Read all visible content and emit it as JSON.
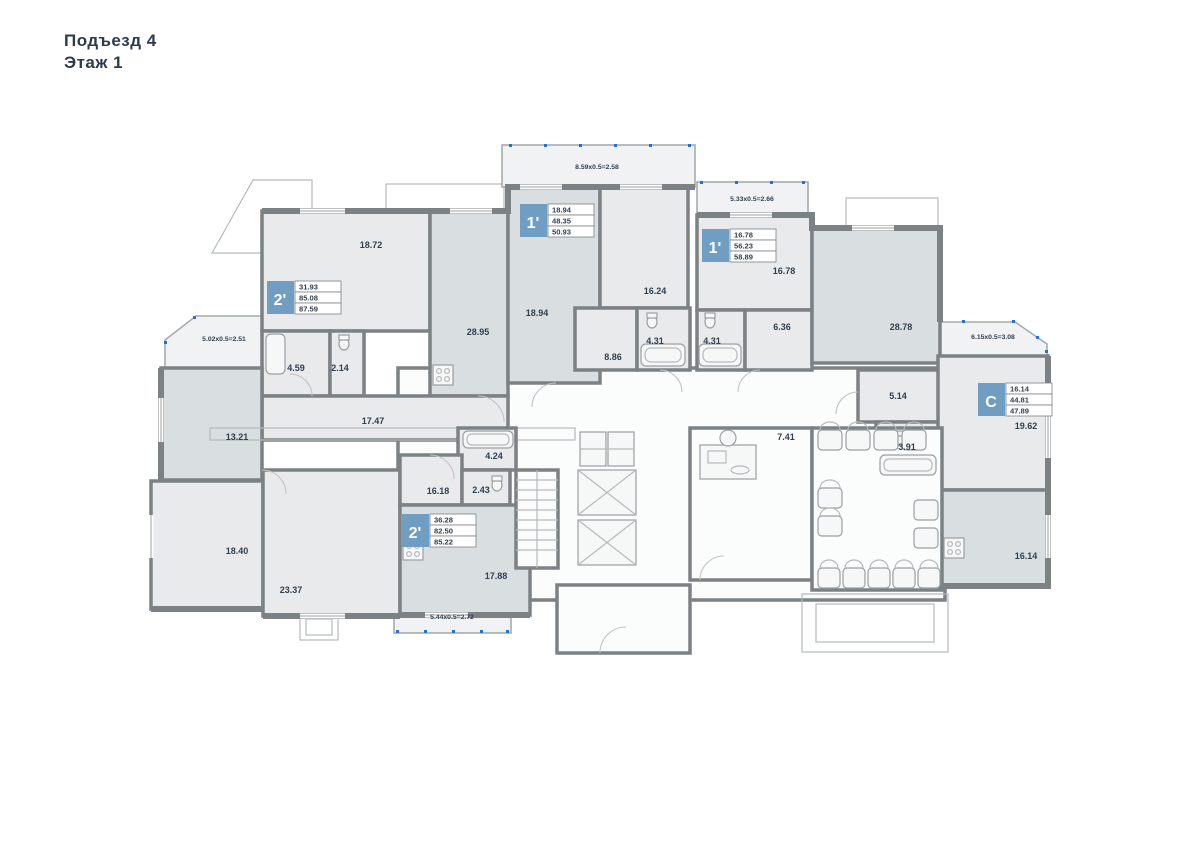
{
  "page": {
    "title_line1": "Подъезд  4",
    "title_line2": "Этаж 1"
  },
  "apartments": [
    {
      "type": "2'",
      "rows": [
        "31.93",
        "85.08",
        "87.59"
      ]
    },
    {
      "type": "1'",
      "rows": [
        "18.94",
        "48.35",
        "50.93"
      ]
    },
    {
      "type": "1'",
      "rows": [
        "16.78",
        "56.23",
        "58.89"
      ]
    },
    {
      "type": "2'",
      "rows": [
        "36.28",
        "82.50",
        "85.22"
      ]
    },
    {
      "type": "С",
      "rows": [
        "16.14",
        "44.81",
        "47.89"
      ]
    }
  ],
  "rooms": [
    {
      "area": "18.72"
    },
    {
      "area": "28.95"
    },
    {
      "area": "18.94"
    },
    {
      "area": "16.24"
    },
    {
      "area": "16.78"
    },
    {
      "area": "28.78"
    },
    {
      "area": "4.59"
    },
    {
      "area": "2.14"
    },
    {
      "area": "8.86"
    },
    {
      "area": "4.31"
    },
    {
      "area": "4.31"
    },
    {
      "area": "6.36"
    },
    {
      "area": "17.47"
    },
    {
      "area": "13.21"
    },
    {
      "area": "5.14"
    },
    {
      "area": "3.91"
    },
    {
      "area": "19.62"
    },
    {
      "area": "7.41"
    },
    {
      "area": "4.24"
    },
    {
      "area": "16.18"
    },
    {
      "area": "2.43"
    },
    {
      "area": "18.40"
    },
    {
      "area": "23.37"
    },
    {
      "area": "17.88"
    },
    {
      "area": "16.14"
    }
  ],
  "balconies": [
    {
      "dim": "8.59x0.5=2.58"
    },
    {
      "dim": "5.33x0.5=2.66"
    },
    {
      "dim": "5.02x0.5=2.51"
    },
    {
      "dim": "6.15x0.5=3.08"
    },
    {
      "dim": "5.44x0.5=2.72"
    }
  ],
  "colors": {
    "badge_blue": "#6f9ec2",
    "wall_gray": "#7c8184",
    "room_fill": "#e8eaeb",
    "room_fill_dark": "#d9dee1",
    "dot_blue": "#2570d4",
    "text_navy": "#32404e"
  }
}
